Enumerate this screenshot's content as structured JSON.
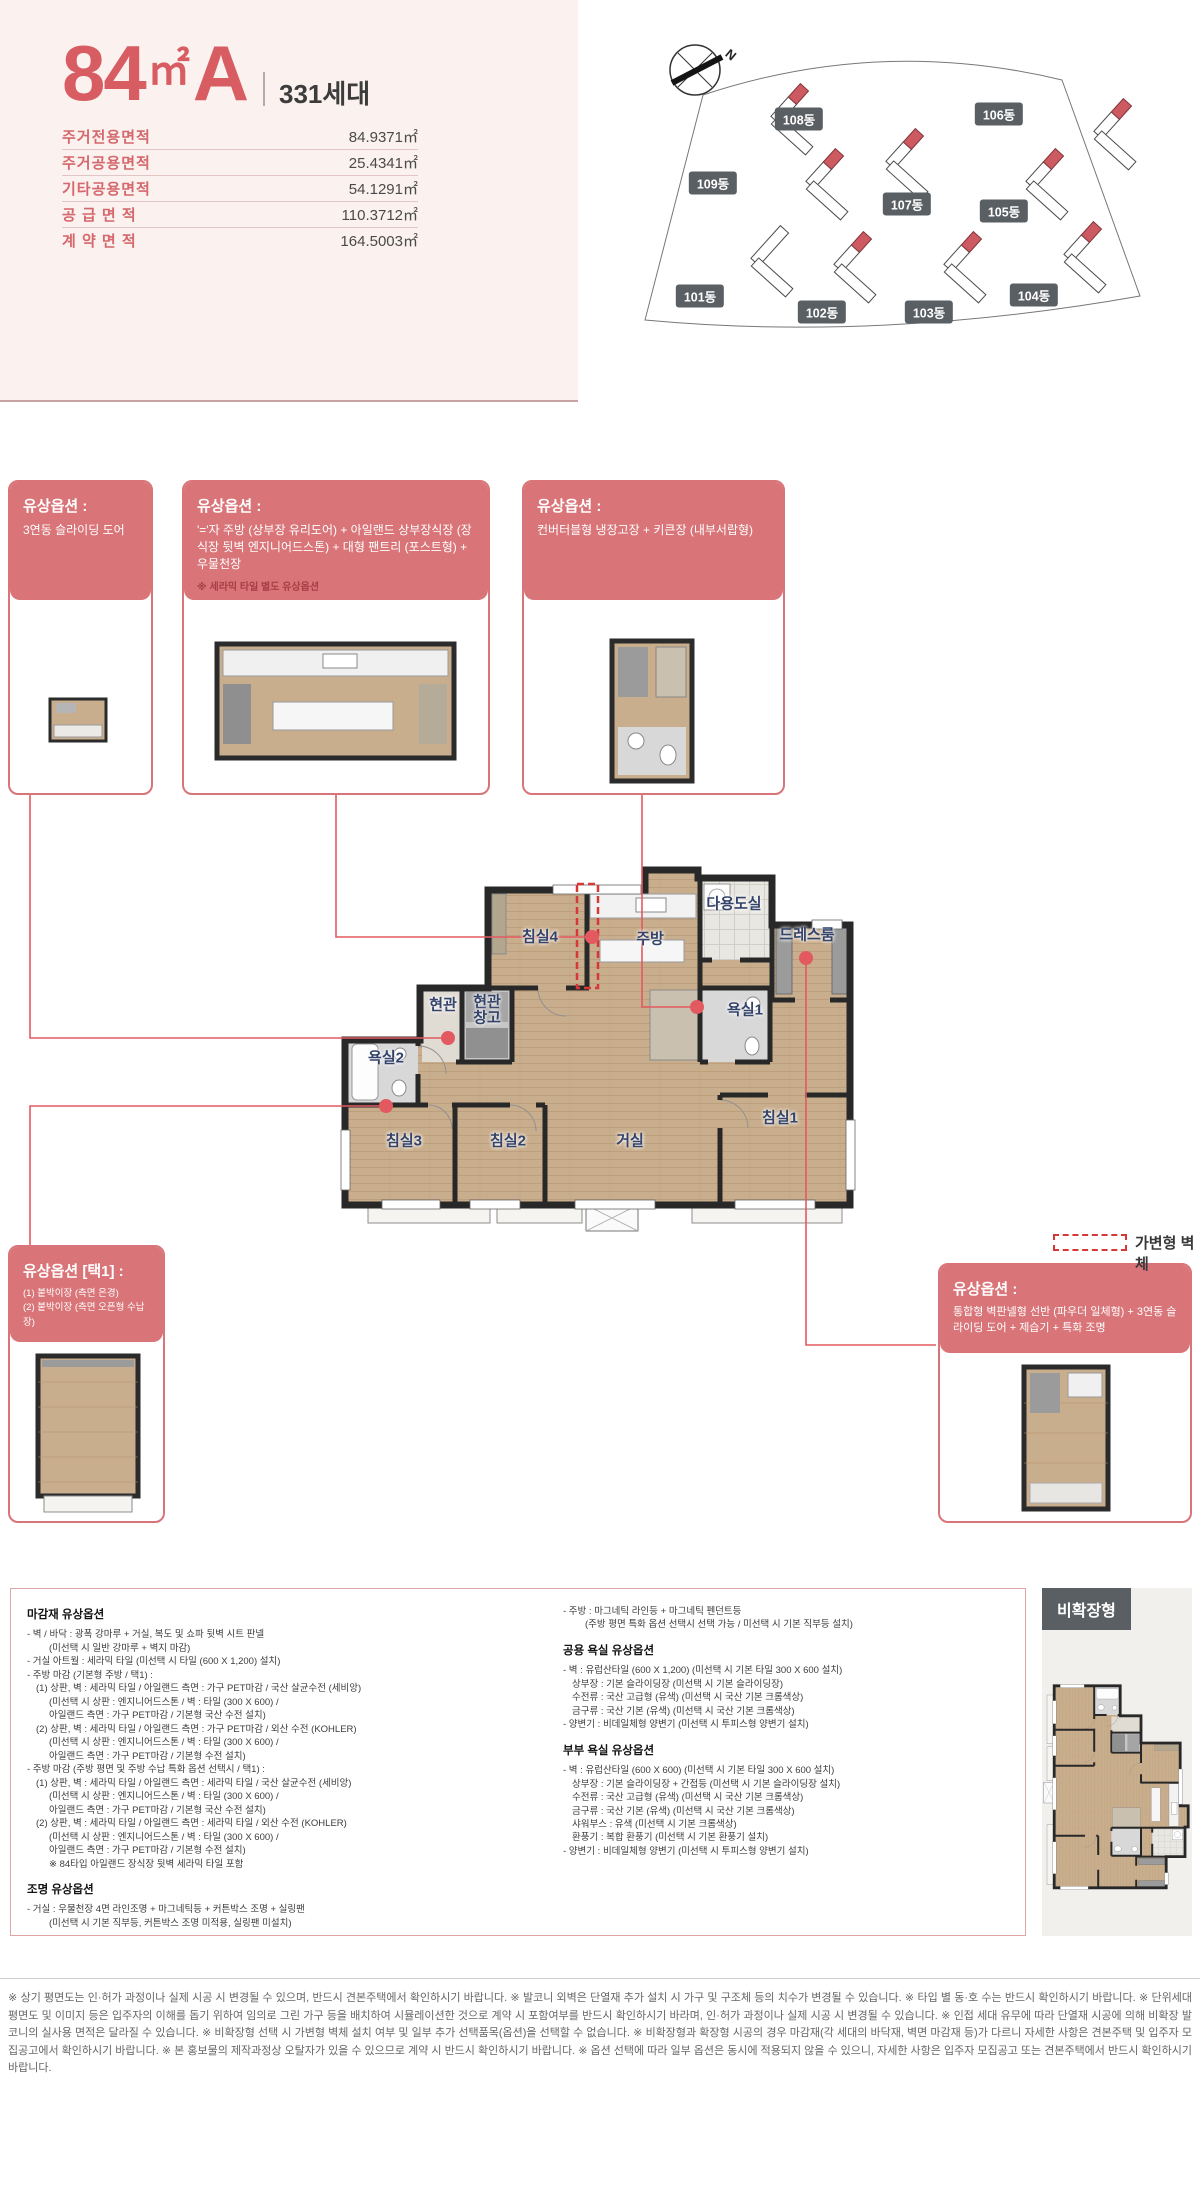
{
  "header": {
    "size": "84",
    "size_unit": "㎡",
    "size_type": "A",
    "units_count": "331세대",
    "area_table": [
      {
        "label": "주거전용면적",
        "value": "84.9371㎡"
      },
      {
        "label": "주거공용면적",
        "value": "25.4341㎡"
      },
      {
        "label": "기타공용면적",
        "value": "54.1291㎡"
      },
      {
        "label": "공 급 면 적",
        "value": "110.3712㎡"
      },
      {
        "label": "계 약 면 적",
        "value": "164.5003㎡"
      }
    ]
  },
  "site_plan": {
    "compass": "N",
    "buildings": [
      "101동",
      "102동",
      "103동",
      "104동",
      "105동",
      "106동",
      "107동",
      "108동",
      "109동"
    ]
  },
  "option_boxes": {
    "door": {
      "title": "유상옵션 :",
      "body": "3연동 슬라이딩 도어"
    },
    "kitchen": {
      "title": "유상옵션 :",
      "body": "'='자 주방 (상부장 유리도어) + 아일랜드 상부장식장 (장식장 뒷벽 엔지니어드스톤) + 대형 팬트리 (포스트형) + 우물천장",
      "note": "※ 세라믹 타일 별도 유상옵션"
    },
    "fridge": {
      "title": "유상옵션 :",
      "body": "컨버터블형 냉장고장 + 키큰장 (내부서랍형)"
    },
    "closet": {
      "title": "유상옵션 [택1] :",
      "body": "(1) 붙박이장 (측면 은경)",
      "body2": "(2) 붙박이장 (측면 오픈형 수납장)"
    },
    "powder": {
      "title": "유상옵션 :",
      "body": "통합형 벽판넬형 선반 (파우더 일체형) + 3연동 슬라이딩 도어 + 제습기 + 특화 조명"
    }
  },
  "floor_plan": {
    "rooms": [
      "침실4",
      "주방",
      "다용도실",
      "드레스룸",
      "현관",
      "현관창고",
      "욕실1",
      "욕실2",
      "침실3",
      "침실2",
      "거실",
      "침실1"
    ],
    "legend": "가변형 벽체"
  },
  "specs": {
    "left": [
      {
        "t": "마감재 유상옵션",
        "c": "sh"
      },
      {
        "t": "- 벽 / 바닥 : 광폭 강마루 + 거실, 복도 및 쇼파 뒷벽 시트 판넬",
        "c": "l0"
      },
      {
        "t": "(미선택 시 일반 강마루 + 벽지 마감)",
        "c": "l2"
      },
      {
        "t": "- 거실 아트월 : 세라믹 타일 (미선택 시 타일 (600 X 1,200) 설치)",
        "c": "l0"
      },
      {
        "t": "- 주방 마감 (기본형 주방 / 택1) :",
        "c": "l0"
      },
      {
        "t": "(1) 상판, 벽 : 세라믹 타일 / 아일랜드 측면 : 가구 PET마감 / 국산 살균수전 (세비앙)",
        "c": "l1"
      },
      {
        "t": "(미선택 시 상판 : 엔지니어드스톤 / 벽 : 타일 (300 X 600) /",
        "c": "l2"
      },
      {
        "t": "아일랜드 측면 : 가구 PET마감 / 기본형 국산 수전 설치)",
        "c": "l2"
      },
      {
        "t": "(2) 상판, 벽 : 세라믹 타일 / 아일랜드 측면 : 가구 PET마감 / 외산 수전 (KOHLER)",
        "c": "l1"
      },
      {
        "t": "(미선택 시 상판 : 엔지니어드스톤 / 벽 : 타일 (300 X 600) /",
        "c": "l2"
      },
      {
        "t": "아일랜드 측면 : 가구 PET마감 / 기본형 수전 설치)",
        "c": "l2"
      },
      {
        "t": "- 주방 마감 (주방 평면 및 주방 수납 특화 옵션 선택시 / 택1) :",
        "c": "l0"
      },
      {
        "t": "(1) 상판, 벽 : 세라믹 타일 / 아일랜드 측면 : 세라믹 타일 / 국산 살균수전 (세비앙)",
        "c": "l1"
      },
      {
        "t": "(미선택 시 상판 : 엔지니어드스톤 / 벽 : 타일 (300 X 600) /",
        "c": "l2"
      },
      {
        "t": "아일랜드 측면 : 가구 PET마감 / 기본형 국산 수전 설치)",
        "c": "l2"
      },
      {
        "t": "(2) 상판, 벽 : 세라믹 타일 / 아일랜드 측면 : 세라믹 타일 / 외산 수전 (KOHLER)",
        "c": "l1"
      },
      {
        "t": "(미선택 시 상판 : 엔지니어드스톤 / 벽 : 타일 (300 X 600) /",
        "c": "l2"
      },
      {
        "t": "아일랜드 측면 : 가구 PET마감 / 기본형 수전 설치)",
        "c": "l2"
      },
      {
        "t": "※ 84타입 아일랜드 장식장 뒷벽 세라믹 타일 포함",
        "c": "l2"
      },
      {
        "t": "",
        "c": "gap"
      },
      {
        "t": "조명 유상옵션",
        "c": "sh"
      },
      {
        "t": "- 거실 : 우물천장 4면 라인조명 + 마그네틱등 + 커튼박스 조명 + 실링팬",
        "c": "l0"
      },
      {
        "t": "(미선택 시 기본 직부등, 커튼박스 조명 미적용, 실링팬 미설치)",
        "c": "l2"
      }
    ],
    "right": [
      {
        "t": "- 주방 : 마그네틱 라인등 + 마그네틱 펜던트등",
        "c": "l0"
      },
      {
        "t": "(주방 평면 특화 옵션 선택시 선택 가능 / 미선택 시 기본 직부등 설치)",
        "c": "l2"
      },
      {
        "t": "",
        "c": "gap"
      },
      {
        "t": "공용 욕실 유상옵션",
        "c": "sh"
      },
      {
        "t": "- 벽 : 유럽산타일 (600 X 1,200) (미선택 시 기본 타일 300 X 600 설치)",
        "c": "l0"
      },
      {
        "t": "상부장 : 기본 슬라이딩장 (미선택 시 기본 슬라이딩장)",
        "c": "l1"
      },
      {
        "t": "수전류 : 국산 고급형 (유색) (미선택 시 국산 기본 크롬색상)",
        "c": "l1"
      },
      {
        "t": "금구류 : 국산 기본 (유색) (미선택 시 국산 기본 크롬색상)",
        "c": "l1"
      },
      {
        "t": "- 양변기 : 비데일체형 양변기 (미선택 시 투피스형 양변기 설치)",
        "c": "l0"
      },
      {
        "t": "",
        "c": "gap"
      },
      {
        "t": "부부 욕실 유상옵션",
        "c": "sh"
      },
      {
        "t": "- 벽 : 유럽산타일 (600 X 600) (미선택 시 기본 타일 300 X 600 설치)",
        "c": "l0"
      },
      {
        "t": "상부장 : 기본 슬라이딩장 + 간접등 (미선택 시 기본 슬라이딩장 설치)",
        "c": "l1"
      },
      {
        "t": "수전류 : 국산 고급형 (유색) (미선택 시 국산 기본 크롬색상)",
        "c": "l1"
      },
      {
        "t": "금구류 : 국산 기본 (유색) (미선택 시 국산 기본 크롬색상)",
        "c": "l1"
      },
      {
        "t": "샤워부스 : 유색 (미선택 시 기본 크롬색상)",
        "c": "l1"
      },
      {
        "t": "환풍기 : 복합 환풍기 (미선택 시 기본 환풍기 설치)",
        "c": "l1"
      },
      {
        "t": "- 양변기 : 비데일체형 양변기 (미선택 시 투피스형 양변기 설치)",
        "c": "l0"
      }
    ]
  },
  "non_expanded": {
    "label": "비확장형"
  },
  "colors": {
    "accent_red": "#d85d62",
    "option_box_red": "#d97478",
    "building_highlight_red": "#cd5a60",
    "room_label_navy": "#33436a",
    "movable_wall_red": "#d63838"
  },
  "disclaimer": "※ 상기 평면도는 인·허가 과정이나 실제 시공 시 변경될 수 있으며, 반드시 견본주택에서 확인하시기 바랍니다. ※ 발코니 외벽은 단열재 추가 설치 시 가구 및 구조체 등의 치수가 변경될 수 있습니다. ※ 타입 별 동·호 수는 반드시 확인하시기 바랍니다. ※ 단위세대 평면도 및 이미지 등은 입주자의 이해를 돕기 위하여 임의로 그린 가구 등을 배치하여 시뮬레이션한 것으로 계약 시 포함여부를 반드시 확인하시기 바라며, 인·허가 과정이나 실제 시공 시 변경될 수 있습니다. ※ 인접 세대 유무에 따라 단열재 시공에 의해 비확장 발코니의 실사용 면적은 달라질 수 있습니다. ※ 비확장형 선택 시 가변형 벽체 설치 여부 및 일부 추가 선택품목(옵션)을 선택할 수 없습니다. ※ 비확장형과 확장형 시공의 경우 마감재(각 세대의 바닥재, 벽면 마감재 등)가 다르니 자세한 사항은 견본주택 및 입주자 모집공고에서 확인하시기 바랍니다. ※ 본 홍보물의 제작과정상 오탈자가 있을 수 있으므로 계약 시 반드시 확인하시기 바랍니다. ※ 옵션 선택에 따라 일부 옵션은 동시에 적용되지 않을 수 있으니, 자세한 사항은 입주자 모집공고 또는 견본주택에서 반드시 확인하시기 바랍니다."
}
